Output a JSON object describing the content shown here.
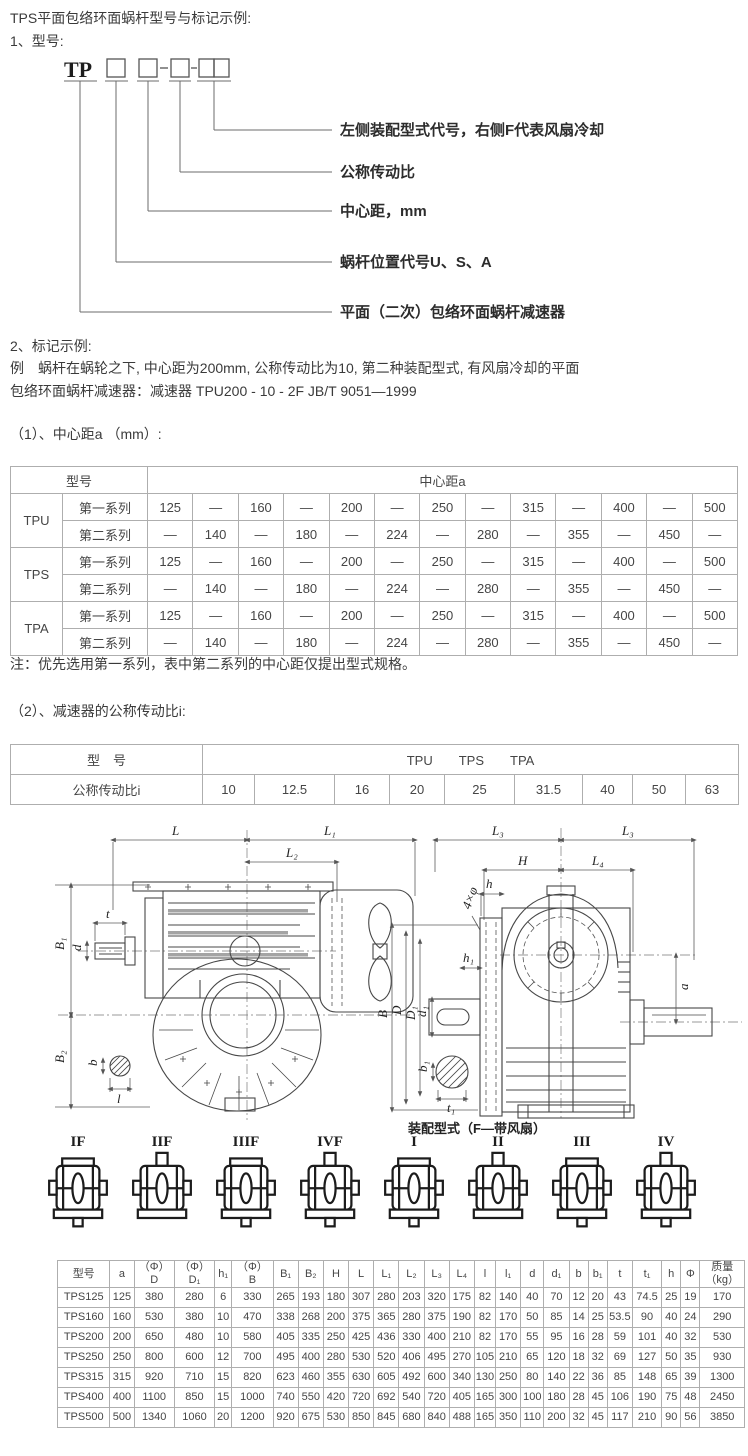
{
  "page": {
    "title": "TPS平面包络环面蜗杆型号与标记示例:",
    "section1_heading": "1、型号:",
    "section2_heading": "2、标记示例:",
    "example_line1": "例　蜗杆在蜗轮之下, 中心距为200mm, 公称传动比为10, 第二种装配型式, 有风扇冷却的平面",
    "example_line2": "包络环面蜗杆减速器：减速器 TPU200 - 10 - 2F JB/T 9051—1999",
    "sub1_heading": "（1）、中心距a （mm）:",
    "table1_note": "注：优先选用第一系列，表中第二系列的中心距仅提出型式规格。",
    "sub2_heading": "（2）、减速器的公称传动比i:"
  },
  "model_diagram": {
    "prefix": "TP",
    "labels": [
      "左侧装配型式代号，右侧F代表风扇冷却",
      "公称传动比",
      "中心距，mm",
      "蜗杆位置代号U、S、A",
      "平面（二次）包络环面蜗杆减速器"
    ]
  },
  "center_distance_table": {
    "rows": [
      [
        {
          "t": "型号",
          "cs": 2
        },
        {
          "t": "中心距a",
          "cs": 13
        }
      ],
      [
        {
          "t": "TPU",
          "rs": 2
        },
        {
          "t": "第一系列"
        },
        "125",
        "—",
        "160",
        "—",
        "200",
        "—",
        "250",
        "—",
        "315",
        "—",
        "400",
        "—",
        "500"
      ],
      [
        {
          "t": "第二系列"
        },
        "—",
        "140",
        "—",
        "180",
        "—",
        "224",
        "—",
        "280",
        "—",
        "355",
        "—",
        "450",
        "—"
      ],
      [
        {
          "t": "TPS",
          "rs": 2
        },
        {
          "t": "第一系列"
        },
        "125",
        "—",
        "160",
        "—",
        "200",
        "—",
        "250",
        "—",
        "315",
        "—",
        "400",
        "—",
        "500"
      ],
      [
        {
          "t": "第二系列"
        },
        "—",
        "140",
        "—",
        "180",
        "—",
        "224",
        "—",
        "280",
        "—",
        "355",
        "—",
        "450",
        "—"
      ],
      [
        {
          "t": "TPA",
          "rs": 2
        },
        {
          "t": "第一系列"
        },
        "125",
        "—",
        "160",
        "—",
        "200",
        "—",
        "250",
        "—",
        "315",
        "—",
        "400",
        "—",
        "500"
      ],
      [
        {
          "t": "第二系列"
        },
        "—",
        "140",
        "—",
        "180",
        "—",
        "224",
        "—",
        "280",
        "—",
        "355",
        "—",
        "450",
        "—"
      ]
    ]
  },
  "ratio_table": {
    "rows": [
      [
        {
          "t": "型　号"
        },
        {
          "t": "TPU　　TPS　　TPA",
          "cs": 9
        }
      ],
      [
        "公称传动比i",
        "10",
        "12.5",
        "16",
        "20",
        "25",
        "31.5",
        "40",
        "50",
        "63"
      ]
    ]
  },
  "drawing": {
    "caption": "装配型式（F—带风扇）",
    "dims": {
      "L": "L",
      "L1": "L₁",
      "L2": "L₂",
      "L3a": "L₃",
      "L3b": "L₃",
      "L4": "L₄",
      "H": "H",
      "B": "B",
      "B1": "B₁",
      "B2": "B₂",
      "D": "D",
      "D1": "D₁",
      "d": "d",
      "d1": "d₁",
      "t": "t",
      "t1": "t₁",
      "b": "b",
      "b1": "b₁",
      "l": "l",
      "h": "h",
      "h1": "h₁",
      "a": "a",
      "phi": "4×φ"
    }
  },
  "assembly": {
    "types": [
      {
        "label": "IF"
      },
      {
        "label": "IIF"
      },
      {
        "label": "IIIF"
      },
      {
        "label": "IVF"
      },
      {
        "label": "I"
      },
      {
        "label": "II"
      },
      {
        "label": "III"
      },
      {
        "label": "IV"
      }
    ]
  },
  "spec_table": {
    "rows": [
      [
        "型号",
        "a",
        "（Φ）\nD",
        "（Φ）\nD₁",
        "h₁",
        "（Φ）\nB",
        "B₁",
        "B₂",
        "H",
        "L",
        "L₁",
        "L₂",
        "L₃",
        "L₄",
        "l",
        "l₁",
        "d",
        "d₁",
        "b",
        "b₁",
        "t",
        "t₁",
        "h",
        "Φ",
        "质量\n（kg）"
      ],
      [
        "TPS125",
        "125",
        "380",
        "280",
        "6",
        "330",
        "265",
        "193",
        "180",
        "307",
        "280",
        "203",
        "320",
        "175",
        "82",
        "140",
        "40",
        "70",
        "12",
        "20",
        "43",
        "74.5",
        "25",
        "19",
        "170"
      ],
      [
        "TPS160",
        "160",
        "530",
        "380",
        "10",
        "470",
        "338",
        "268",
        "200",
        "375",
        "365",
        "280",
        "375",
        "190",
        "82",
        "170",
        "50",
        "85",
        "14",
        "25",
        "53.5",
        "90",
        "40",
        "24",
        "290"
      ],
      [
        "TPS200",
        "200",
        "650",
        "480",
        "10",
        "580",
        "405",
        "335",
        "250",
        "425",
        "436",
        "330",
        "400",
        "210",
        "82",
        "170",
        "55",
        "95",
        "16",
        "28",
        "59",
        "101",
        "40",
        "32",
        "530"
      ],
      [
        "TPS250",
        "250",
        "800",
        "600",
        "12",
        "700",
        "495",
        "400",
        "280",
        "530",
        "520",
        "406",
        "495",
        "270",
        "105",
        "210",
        "65",
        "120",
        "18",
        "32",
        "69",
        "127",
        "50",
        "35",
        "930"
      ],
      [
        "TPS315",
        "315",
        "920",
        "710",
        "15",
        "820",
        "623",
        "460",
        "355",
        "630",
        "605",
        "492",
        "600",
        "340",
        "130",
        "250",
        "80",
        "140",
        "22",
        "36",
        "85",
        "148",
        "65",
        "39",
        "1300"
      ],
      [
        "TPS400",
        "400",
        "1100",
        "850",
        "15",
        "1000",
        "740",
        "550",
        "420",
        "720",
        "692",
        "540",
        "720",
        "405",
        "165",
        "300",
        "100",
        "180",
        "28",
        "45",
        "106",
        "190",
        "75",
        "48",
        "2450"
      ],
      [
        "TPS500",
        "500",
        "1340",
        "1060",
        "20",
        "1200",
        "920",
        "675",
        "530",
        "850",
        "845",
        "680",
        "840",
        "488",
        "165",
        "350",
        "110",
        "200",
        "32",
        "45",
        "117",
        "210",
        "90",
        "56",
        "3850"
      ]
    ]
  }
}
